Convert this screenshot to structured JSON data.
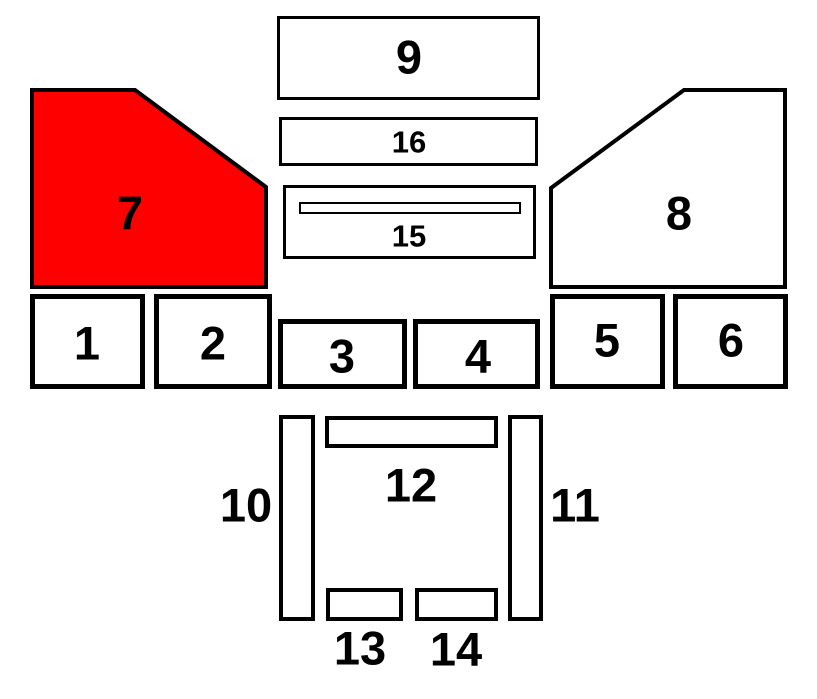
{
  "diagram": {
    "title": "numbered-parts-diagram",
    "highlighted_part": "7",
    "colors": {
      "background": "#ffffff",
      "outline": "#000000",
      "highlight": "#fe0000",
      "shape_fill": "#ffffff"
    },
    "parts": {
      "part1": {
        "label": "1"
      },
      "part2": {
        "label": "2"
      },
      "part3": {
        "label": "3"
      },
      "part4": {
        "label": "4"
      },
      "part5": {
        "label": "5"
      },
      "part6": {
        "label": "6"
      },
      "part7": {
        "label": "7"
      },
      "part8": {
        "label": "8"
      },
      "part9": {
        "label": "9"
      },
      "part10": {
        "label": "10"
      },
      "part11": {
        "label": "11"
      },
      "part12": {
        "label": "12"
      },
      "part13": {
        "label": "13"
      },
      "part14": {
        "label": "14"
      },
      "part15": {
        "label": "15"
      },
      "part16": {
        "label": "16"
      }
    }
  }
}
